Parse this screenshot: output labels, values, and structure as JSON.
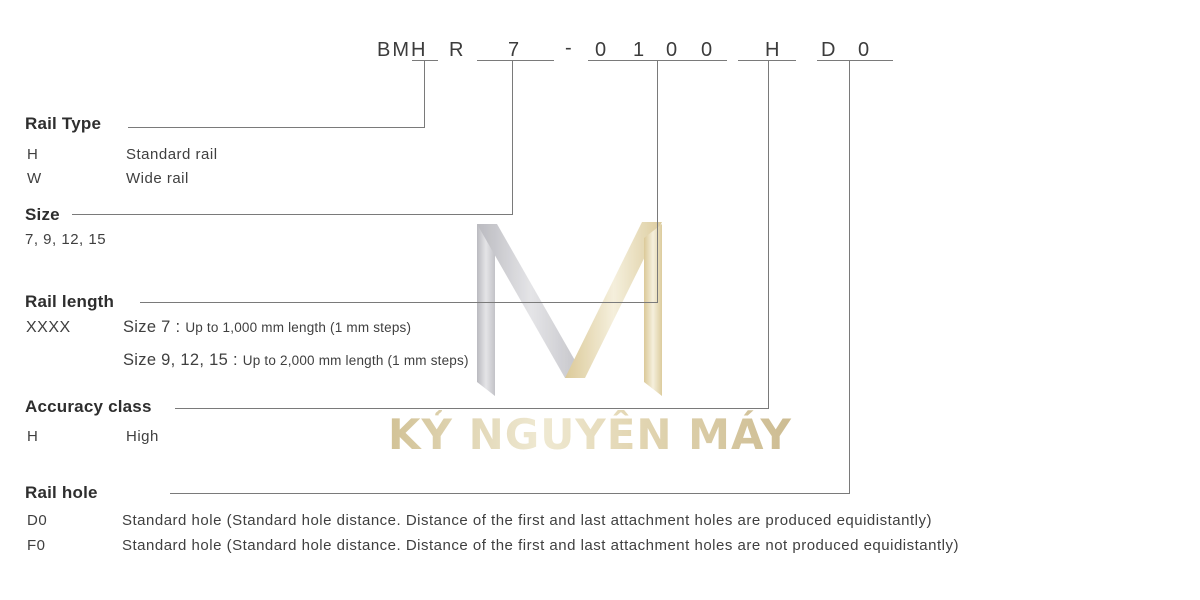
{
  "part_number": {
    "model_prefix": "BMH",
    "rail_symbol": "R",
    "size_value": "7",
    "separator": "-",
    "length_digits": [
      "0",
      "1",
      "0",
      "0"
    ],
    "accuracy_value": "H",
    "hole_letter": "D",
    "hole_digit": "0"
  },
  "sections": {
    "rail_type": {
      "title": "Rail Type",
      "rows": [
        {
          "code": "H",
          "desc": "Standard rail"
        },
        {
          "code": "W",
          "desc": "Wide rail"
        }
      ]
    },
    "size": {
      "title": "Size",
      "values": "7, 9, 12, 15"
    },
    "rail_length": {
      "title": "Rail length",
      "code": "XXXX",
      "rows": [
        {
          "label": "Size 7 : ",
          "detail": "Up to 1,000 mm length (1 mm steps)"
        },
        {
          "label": "Size 9, 12, 15 : ",
          "detail": "Up to 2,000 mm length (1 mm steps)"
        }
      ]
    },
    "accuracy_class": {
      "title": "Accuracy class",
      "rows": [
        {
          "code": "H",
          "desc": "High"
        }
      ]
    },
    "rail_hole": {
      "title": "Rail hole",
      "rows": [
        {
          "code": "D0",
          "desc": "Standard hole (Standard hole distance. Distance of the first and last attachment holes are produced equidistantly)"
        },
        {
          "code": "F0",
          "desc": "Standard hole (Standard hole distance. Distance of the first and last attachment holes are not produced equidistantly)"
        }
      ]
    }
  },
  "watermark": {
    "text": "KỶ NGUYÊN MÁY",
    "logo": "m-monogram"
  },
  "colors": {
    "body_text": "#3f3f3f",
    "heading_text": "#2e2e2e",
    "connector_line": "#7a7a7a",
    "watermark_gray": "#c9c9cd",
    "watermark_gold": "#e8ddb6",
    "watermark_text": "#d9cba3"
  }
}
